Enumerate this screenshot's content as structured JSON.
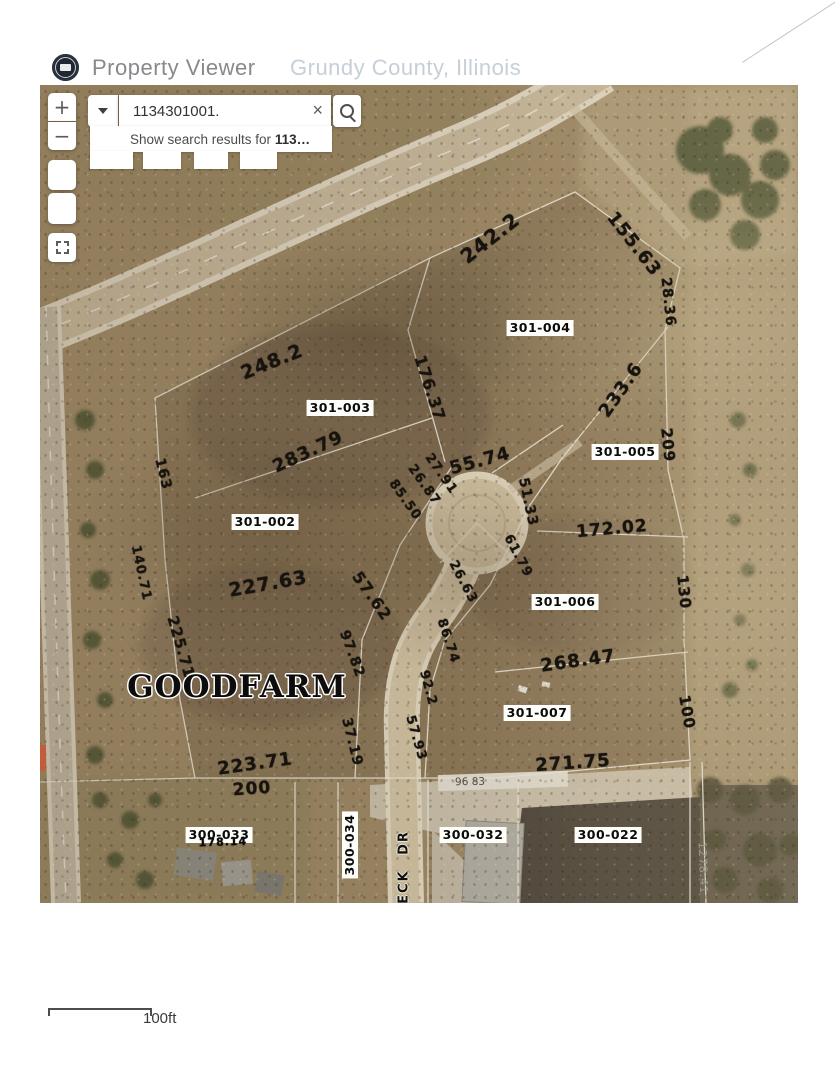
{
  "header": {
    "app_title": "Property Viewer",
    "subtitle": "Grundy County, Illinois",
    "title_color": "#87898c",
    "subtitle_color": "#c6cfd7"
  },
  "search": {
    "query": "1134301001.",
    "clear_glyph": "×",
    "suggestion_prefix": "Show search results for ",
    "suggestion_query": "113…"
  },
  "controls": {
    "zoom_in": "+",
    "zoom_out": "−"
  },
  "map": {
    "place_label": "GOODFARM",
    "street_label": "ECK DR",
    "survey_value": "96 83",
    "edge_value": "1278.41",
    "parcels": [
      {
        "id": "301-004",
        "x": 500,
        "y": 243,
        "r": 0
      },
      {
        "id": "301-003",
        "x": 300,
        "y": 323,
        "r": 0
      },
      {
        "id": "301-005",
        "x": 585,
        "y": 367,
        "r": 0
      },
      {
        "id": "301-002",
        "x": 225,
        "y": 437,
        "r": 0
      },
      {
        "id": "301-006",
        "x": 525,
        "y": 517,
        "r": 0
      },
      {
        "id": "301-007",
        "x": 497,
        "y": 628,
        "r": 0
      },
      {
        "id": "300-033",
        "x": 179,
        "y": 750,
        "r": 0
      },
      {
        "id": "300-034",
        "x": 310,
        "y": 760,
        "r": -90
      },
      {
        "id": "300-032",
        "x": 433,
        "y": 750,
        "r": 0
      },
      {
        "id": "300-022",
        "x": 568,
        "y": 750,
        "r": 0
      }
    ],
    "overlapping_dimension": {
      "v": "178.14",
      "x": 183,
      "y": 757,
      "r": -2
    },
    "measurements": [
      {
        "v": "242.2",
        "x": 450,
        "y": 153,
        "r": -38,
        "s": 20
      },
      {
        "v": "155.63",
        "x": 594,
        "y": 159,
        "r": 52,
        "s": 18
      },
      {
        "v": "28.36",
        "x": 628,
        "y": 217,
        "r": 84,
        "s": 14
      },
      {
        "v": "248.2",
        "x": 232,
        "y": 277,
        "r": -22,
        "s": 19
      },
      {
        "v": "233.6",
        "x": 581,
        "y": 305,
        "r": -55,
        "s": 18
      },
      {
        "v": "176.37",
        "x": 390,
        "y": 303,
        "r": 72,
        "s": 16
      },
      {
        "v": "209",
        "x": 628,
        "y": 360,
        "r": 84,
        "s": 15
      },
      {
        "v": "283.79",
        "x": 268,
        "y": 367,
        "r": -25,
        "s": 18
      },
      {
        "v": "55.74",
        "x": 440,
        "y": 376,
        "r": -15,
        "s": 18
      },
      {
        "v": "85.50",
        "x": 365,
        "y": 415,
        "r": 55,
        "s": 13
      },
      {
        "v": "26.87",
        "x": 384,
        "y": 400,
        "r": 55,
        "s": 13
      },
      {
        "v": "27.91",
        "x": 401,
        "y": 389,
        "r": 55,
        "s": 13
      },
      {
        "v": "51.33",
        "x": 488,
        "y": 417,
        "r": 78,
        "s": 14
      },
      {
        "v": "172.02",
        "x": 572,
        "y": 444,
        "r": -5,
        "s": 17
      },
      {
        "v": "61.79",
        "x": 478,
        "y": 471,
        "r": 62,
        "s": 13
      },
      {
        "v": "26.63",
        "x": 423,
        "y": 497,
        "r": 62,
        "s": 13
      },
      {
        "v": "57.62",
        "x": 332,
        "y": 511,
        "r": 55,
        "s": 16
      },
      {
        "v": "130",
        "x": 644,
        "y": 507,
        "r": 84,
        "s": 15
      },
      {
        "v": "227.63",
        "x": 228,
        "y": 499,
        "r": -10,
        "s": 19
      },
      {
        "v": "97.82",
        "x": 312,
        "y": 569,
        "r": 70,
        "s": 14
      },
      {
        "v": "86.74",
        "x": 408,
        "y": 556,
        "r": 72,
        "s": 13
      },
      {
        "v": "268.47",
        "x": 538,
        "y": 576,
        "r": -8,
        "s": 18
      },
      {
        "v": "163",
        "x": 123,
        "y": 389,
        "r": 76,
        "s": 14
      },
      {
        "v": "140.71",
        "x": 101,
        "y": 488,
        "r": 78,
        "s": 13
      },
      {
        "v": "225.71",
        "x": 141,
        "y": 562,
        "r": 74,
        "s": 15
      },
      {
        "v": "92.2",
        "x": 388,
        "y": 603,
        "r": 75,
        "s": 13
      },
      {
        "v": "100",
        "x": 647,
        "y": 627,
        "r": 80,
        "s": 15
      },
      {
        "v": "57.93",
        "x": 376,
        "y": 653,
        "r": 74,
        "s": 13
      },
      {
        "v": "37.19",
        "x": 312,
        "y": 657,
        "r": 76,
        "s": 14
      },
      {
        "v": "223.71",
        "x": 215,
        "y": 679,
        "r": -8,
        "s": 18
      },
      {
        "v": "200",
        "x": 212,
        "y": 704,
        "r": -4,
        "s": 17
      },
      {
        "v": "271.75",
        "x": 533,
        "y": 678,
        "r": -4,
        "s": 18
      }
    ]
  },
  "scale_bar": {
    "label": "100ft"
  }
}
